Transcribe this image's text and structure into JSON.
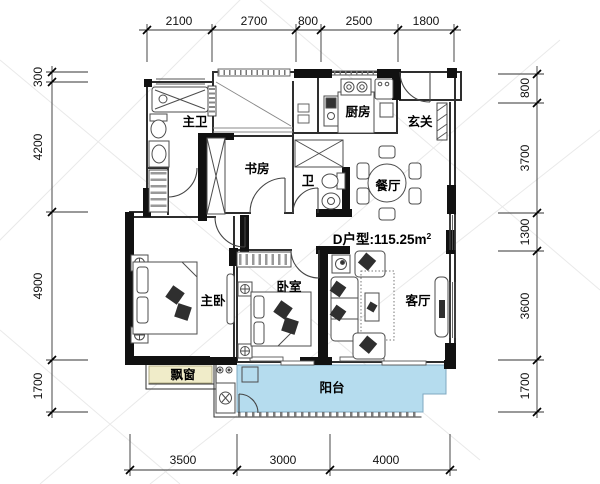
{
  "plan": {
    "unit_label": "D户型:115.25m",
    "unit_area_sup": "2",
    "rooms": {
      "master_bath": "主卫",
      "study": "书房",
      "bath": "卫",
      "kitchen": "厨房",
      "foyer": "玄关",
      "dining": "餐厅",
      "master_bedroom": "主卧",
      "bedroom": "卧室",
      "living": "客厅",
      "bay_window": "飘窗",
      "balcony": "阳台"
    },
    "colors": {
      "wall": "#111111",
      "balcony_fill": "#b5dcee",
      "bay_window_fill": "#f0ecc9"
    }
  },
  "dimensions": {
    "top": [
      "2100",
      "2700",
      "800",
      "2500",
      "1800"
    ],
    "left": [
      "300",
      "4200",
      "4900",
      "1700"
    ],
    "right": [
      "800",
      "3700",
      "1300",
      "3600",
      "1700"
    ],
    "bottom": [
      "3500",
      "3000",
      "4000"
    ]
  }
}
